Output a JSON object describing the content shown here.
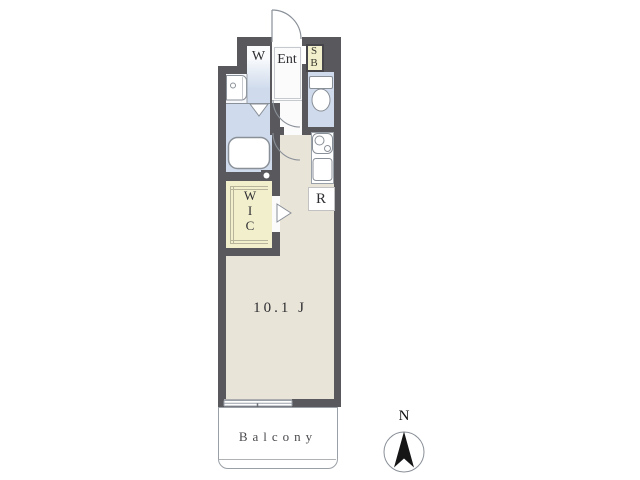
{
  "plan": {
    "rooms": {
      "washing_machine": "W",
      "entrance": "Ent",
      "shoe_box": {
        "top": "S",
        "bottom": "B"
      },
      "wic": {
        "l1": "W",
        "l2": "I",
        "l3": "C"
      },
      "refrigerator": "R",
      "main_room": "10.1 J",
      "balcony": "Balcony"
    },
    "compass": {
      "north": "N"
    },
    "colors": {
      "wall": "#58585d",
      "water_area": "#cfdbec",
      "living_floor": "#e9e4d8",
      "closet": "#f2efcd",
      "balcony_border": "#9aa0a6"
    }
  }
}
